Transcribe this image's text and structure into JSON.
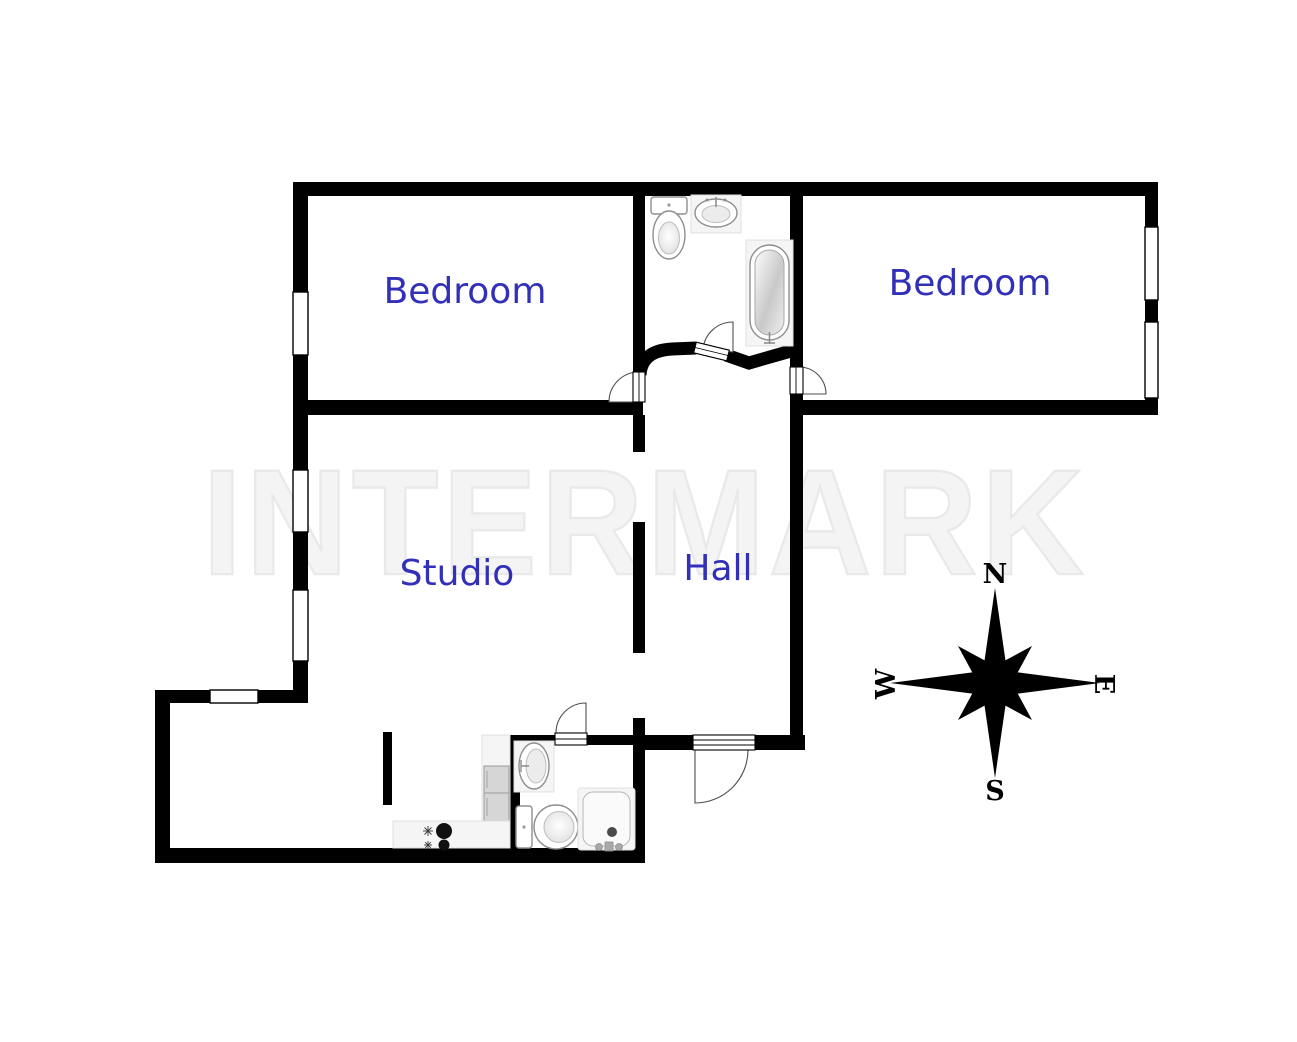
{
  "watermark": {
    "text": "INTERMARK"
  },
  "rooms": [
    {
      "label": "Bedroom"
    },
    {
      "label": "Bedroom"
    },
    {
      "label": "Studio"
    },
    {
      "label": "Hall"
    }
  ],
  "compass": {
    "north": "N",
    "east": "E",
    "south": "S",
    "west": "W"
  },
  "colors": {
    "label": "#3230b8",
    "wall": "#000000",
    "watermark-fill": "#f4f4f4",
    "watermark-stroke": "#e9e9e9",
    "fixture-stroke": "#8f8f8f"
  },
  "fixtures": {
    "top_bathroom": [
      "toilet-icon",
      "sink-icon",
      "bathtub-icon"
    ],
    "bottom_bathroom": [
      "sink-icon",
      "toilet-icon",
      "shower-icon"
    ],
    "kitchen": [
      "cabinet-icon",
      "stove-icon"
    ]
  }
}
